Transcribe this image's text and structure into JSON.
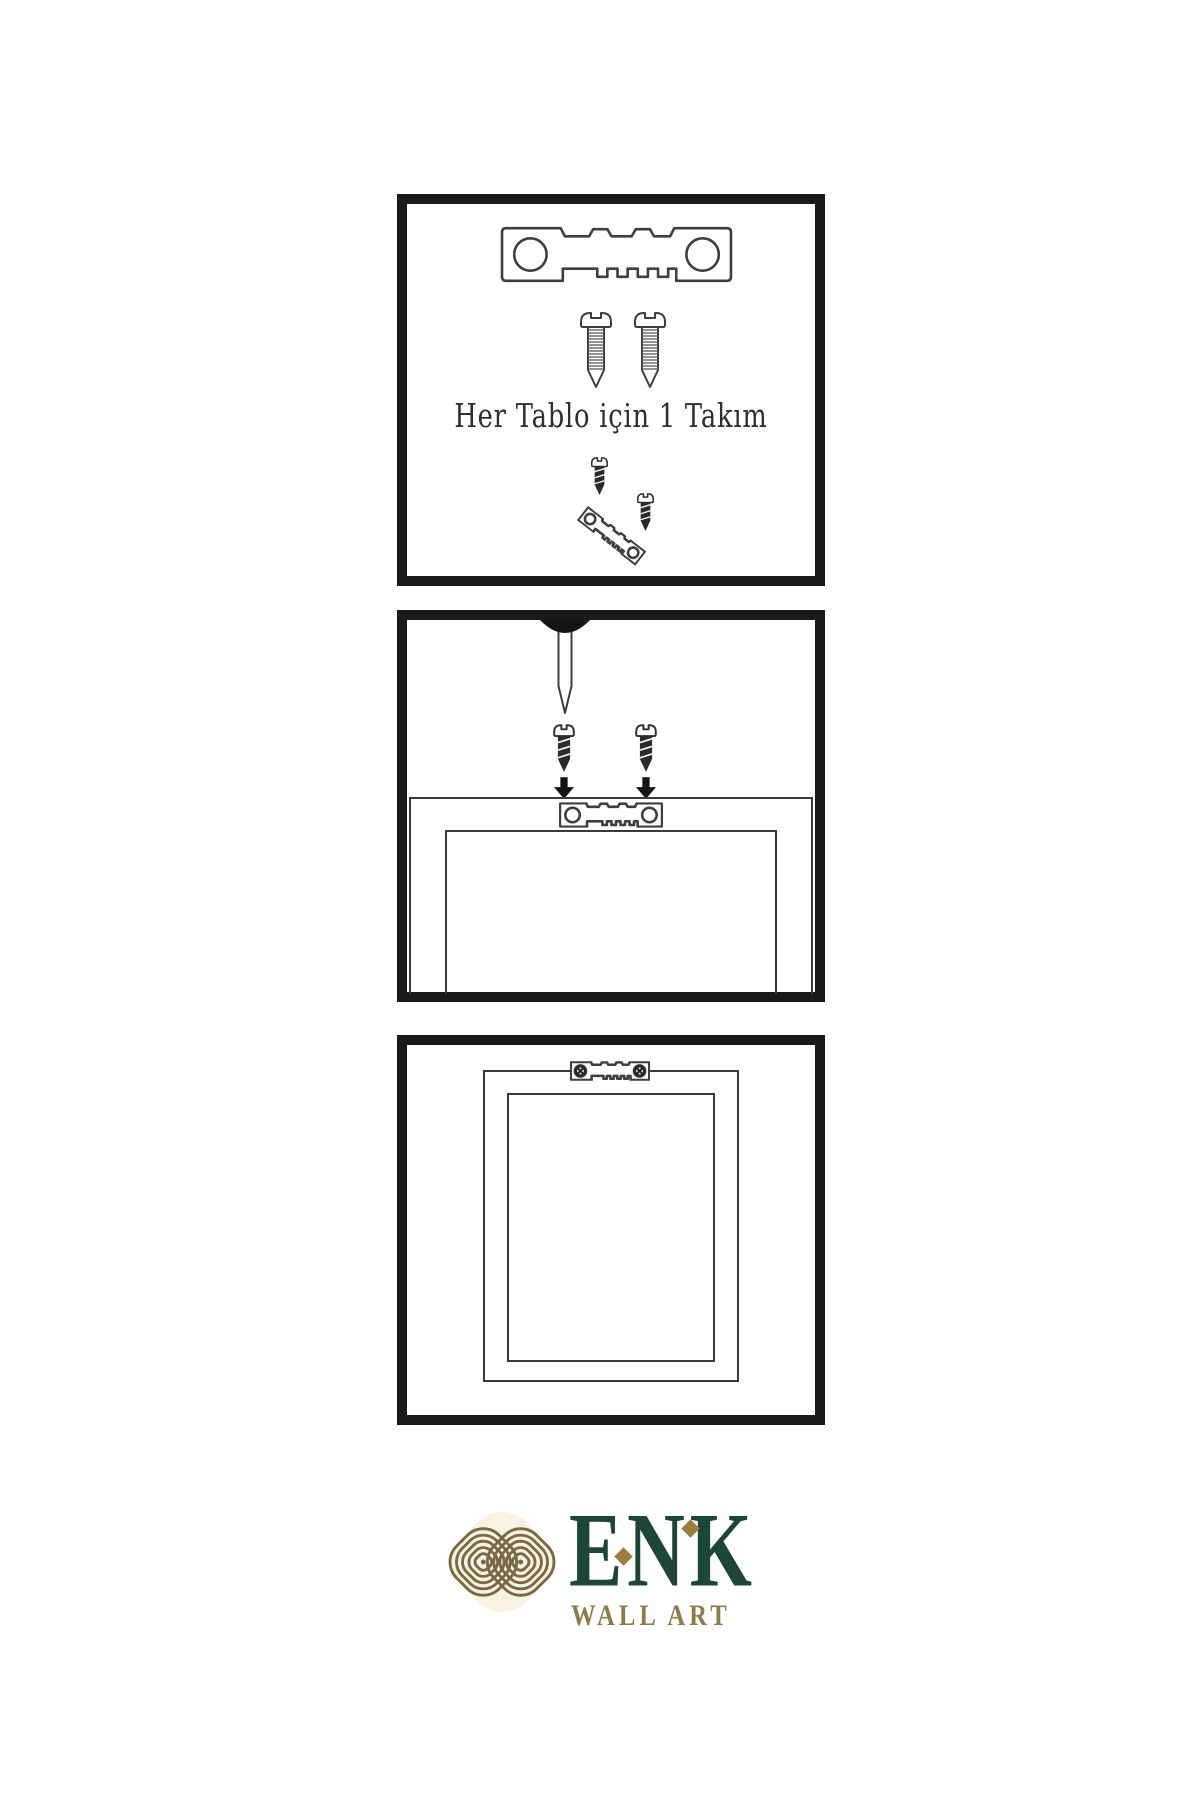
{
  "document": {
    "background": "#ffffff",
    "type": "picture-hanging-instruction-sheet"
  },
  "panels": {
    "kit": {
      "caption": "Her Tablo için 1 Takım",
      "icons": [
        "sawtooth-hanger-icon",
        "screw-icon",
        "screw-icon",
        "hanger-assembly-icon"
      ]
    },
    "install": {
      "icons": [
        "nail-icon",
        "screw-dark-icon",
        "screw-dark-icon",
        "down-arrow-icon",
        "down-arrow-icon",
        "frame-back-outline",
        "sawtooth-hanger-icon"
      ]
    },
    "result": {
      "icons": [
        "frame-outline",
        "sawtooth-hanger-mounted-icon"
      ]
    }
  },
  "logo": {
    "brand": "ENK",
    "subtitle": "WALL ART",
    "icon": "interlocking-knot-icon",
    "colors": {
      "brand_green": "#1d4538",
      "gold": "#9c7c3c",
      "subtitle_gold": "#8e7b4b",
      "knot_gold": "#786844"
    }
  },
  "colors": {
    "panel_border": "#1a1a1a",
    "line_art": "#3f3f3f",
    "screw_dark": "#2b2b2b"
  }
}
